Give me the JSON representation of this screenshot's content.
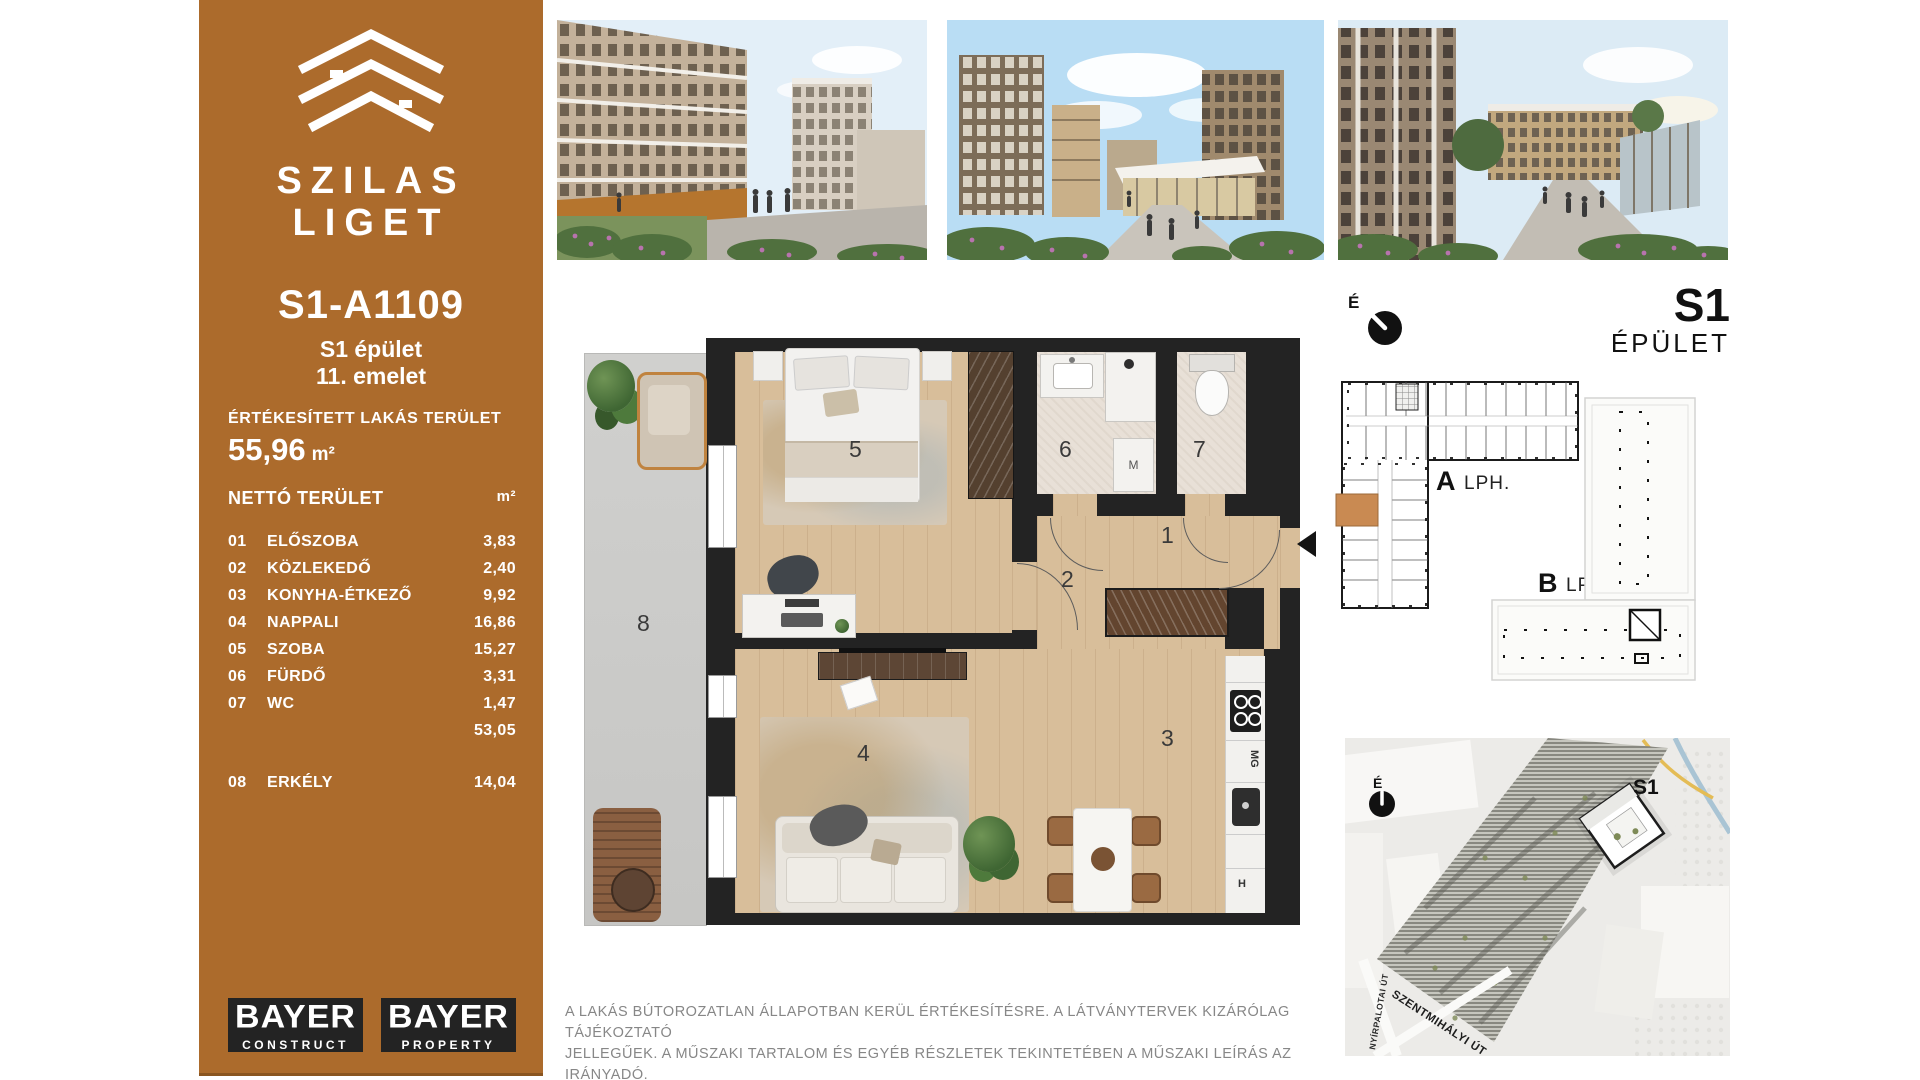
{
  "colors": {
    "brand_brown": "#AC6B2C",
    "unit_highlight": "#C98A52",
    "wall_black": "#232323",
    "wood_floor": "#D8BE9A",
    "balcony_gray": "#CBCBC9",
    "tile_floor": "#E8E0D7"
  },
  "sidebar": {
    "brand_line1": "SZILAS",
    "brand_line2": "LIGET",
    "apartment_id": "S1-A1109",
    "building_line": "S1 épület",
    "floor_line": "11. emelet",
    "sold_area_label": "ÉRTÉKESÍTETT LAKÁS TERÜLET",
    "sold_area_value": "55,96",
    "sold_area_unit": "m²",
    "net_area_label": "NETTÓ TERÜLET",
    "net_area_unit": "m²",
    "rooms": [
      {
        "num": "01",
        "name": "ELŐSZOBA",
        "area": "3,83"
      },
      {
        "num": "02",
        "name": "KÖZLEKEDŐ",
        "area": "2,40"
      },
      {
        "num": "03",
        "name": "KONYHA-ÉTKEZŐ",
        "area": "9,92"
      },
      {
        "num": "04",
        "name": "NAPPALI",
        "area": "16,86"
      },
      {
        "num": "05",
        "name": "SZOBA",
        "area": "15,27"
      },
      {
        "num": "06",
        "name": "FÜRDŐ",
        "area": "3,31"
      },
      {
        "num": "07",
        "name": "WC",
        "area": "1,47"
      }
    ],
    "subtotal": "53,05",
    "balcony_row": {
      "num": "08",
      "name": "ERKÉLY",
      "area": "14,04"
    },
    "logo1_name": "BAYER",
    "logo1_sub": "CONSTRUCT",
    "logo2_name": "BAYER",
    "logo2_sub": "PROPERTY"
  },
  "floorplan": {
    "labels": {
      "1": "1",
      "2": "2",
      "3": "3",
      "4": "4",
      "5": "5",
      "6": "6",
      "7": "7",
      "8": "8"
    },
    "washer": "M",
    "dishwasher": "MG",
    "fridge": "H"
  },
  "keyplan": {
    "compass": "É",
    "code": "S1",
    "building_word": "ÉPÜLET",
    "stair_a": "A",
    "stair_a_suffix": "LPH.",
    "stair_b": "B",
    "stair_b_suffix": "LPH."
  },
  "sitemap": {
    "compass": "É",
    "code": "S1",
    "street_left": "NYÍRPALOTAI ÚT",
    "street_bottom": "SZENTMIHÁLYI ÚT"
  },
  "disclaimer": {
    "line1": "A LAKÁS BÚTOROZATLAN ÁLLAPOTBAN KERÜL ÉRTÉKESÍTÉSRE. A LÁTVÁNYTERVEK KIZÁRÓLAG TÁJÉKOZTATÓ",
    "line2": "JELLEGŰEK. A MŰSZAKI TARTALOM ÉS EGYÉB RÉSZLETEK TEKINTETÉBEN A MŰSZAKI LEÍRÁS AZ IRÁNYADÓ."
  }
}
